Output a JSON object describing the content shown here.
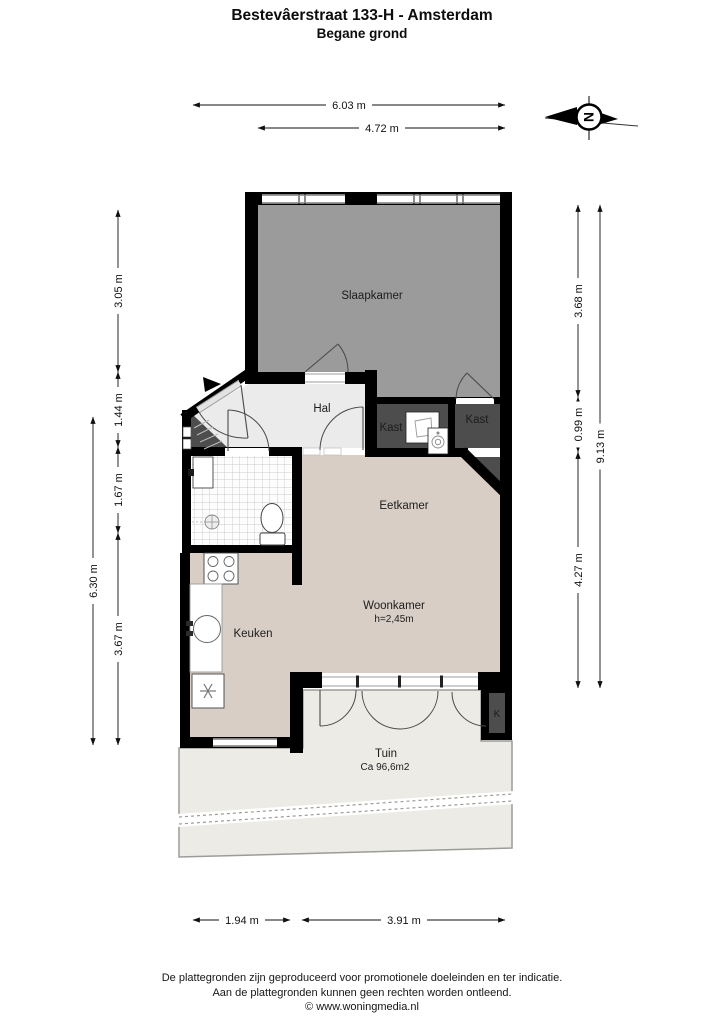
{
  "header": {
    "title": "Bestevâerstraat 133-H - Amsterdam",
    "subtitle": "Begane grond"
  },
  "compass": {
    "north_letter": "N"
  },
  "rooms": {
    "slaapkamer": {
      "label": "Slaapkamer"
    },
    "hal": {
      "label": "Hal"
    },
    "kast_links": {
      "label": "Kast"
    },
    "kast_rechts": {
      "label": "Kast"
    },
    "eetkamer": {
      "label": "Eetkamer"
    },
    "woonkamer": {
      "label": "Woonkamer",
      "height": "h=2,45m"
    },
    "keuken": {
      "label": "Keuken"
    },
    "tuin": {
      "label": "Tuin",
      "area": "Ca 96,6m2"
    },
    "kast_k": {
      "label": "K"
    }
  },
  "dimensions": {
    "top_total": "6.03 m",
    "top_inner": "4.72 m",
    "left_outer_total": "6.30 m",
    "left_seg1": "3.05 m",
    "left_seg2": "1.44 m",
    "left_seg3": "1.67 m",
    "left_seg4": "3.67 m",
    "right_seg1": "3.68 m",
    "right_seg2": "0.99 m",
    "right_seg3": "4.27 m",
    "right_outer_total": "9.13 m",
    "bottom_left": "1.94 m",
    "bottom_right": "3.91 m"
  },
  "footer": {
    "line1": "De plattegronden zijn geproduceerd voor promotionele doeleinden en ter indicatie.",
    "line2": "Aan de plattegronden kunnen geen rechten worden ontleend.",
    "line3": "© www.woningmedia.nl"
  },
  "colors": {
    "wall": "#000000",
    "slaapkamer_floor": "#9b9b9b",
    "hal_floor": "#ebebeb",
    "kast_floor": "#4d4d4d",
    "living_floor": "#d8cec6",
    "tuin": "#ecebe6"
  }
}
